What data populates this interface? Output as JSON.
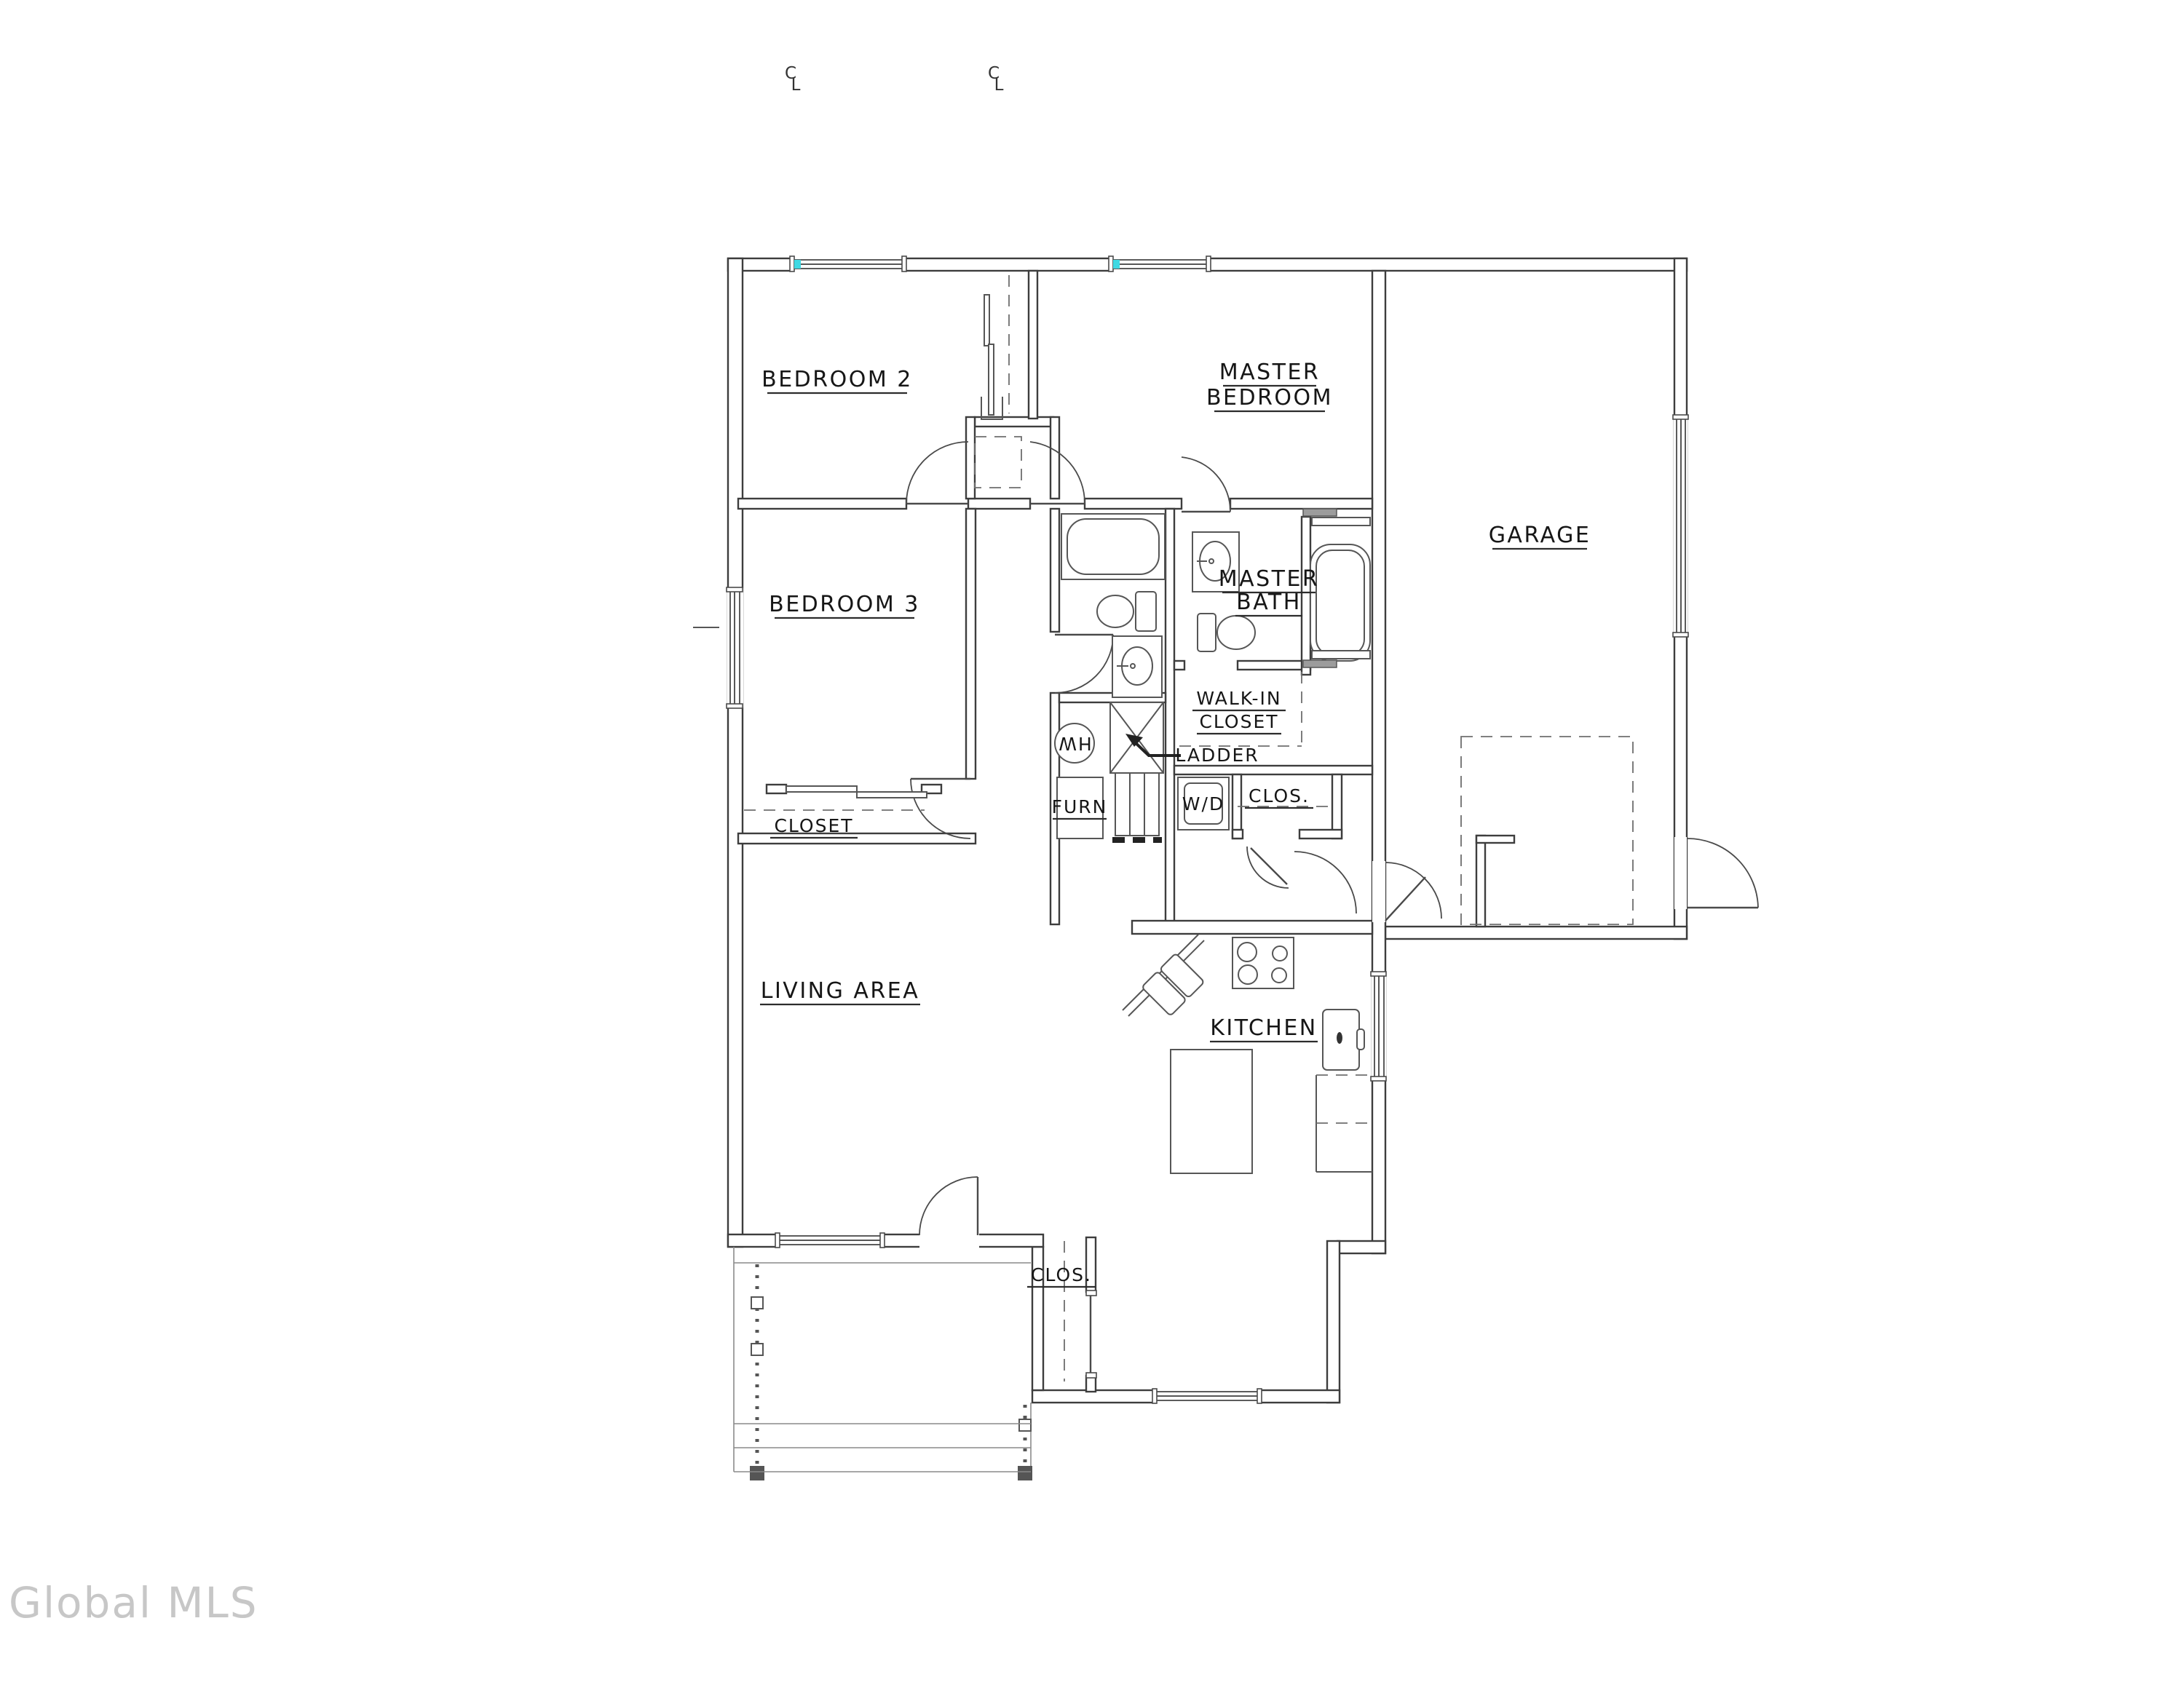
{
  "document": {
    "type": "residential floor plan drawing",
    "watermark": "Global MLS"
  },
  "colors": {
    "background": "#ffffff",
    "wall_line": "#3d3d3d",
    "window_marker_cyan": "#3fd9e3",
    "watermark_gray": "#c7c7c7"
  },
  "labels": {
    "bedroom2": "BEDROOM 2",
    "master_bedroom": [
      "MASTER",
      "BEDROOM"
    ],
    "bedroom3": "BEDROOM 3",
    "master_bath": [
      "MASTER",
      "BATH"
    ],
    "walk_in_closet": [
      "WALK-IN",
      "CLOSET"
    ],
    "garage": "GARAGE",
    "living_area": "LIVING AREA",
    "kitchen": "KITCHEN",
    "closet_bedroom3": "CLOSET",
    "closet_hall": "CLOS.",
    "closet_entry": "CLOS.",
    "ladder": "LADDER",
    "furnace": "FURN",
    "washer_dryer": "W/D",
    "water_heater": "HW"
  },
  "symbols": {
    "centerline_c": "C",
    "centerline_l": "L"
  }
}
